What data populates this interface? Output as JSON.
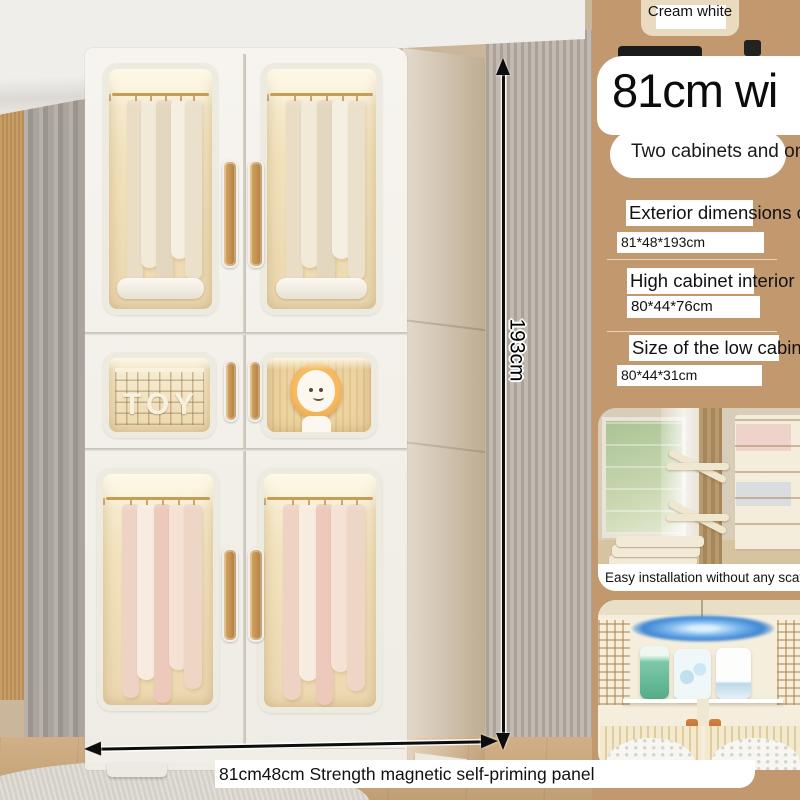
{
  "product": {
    "color_badge": "Cream white",
    "headline": "81cm wi",
    "subtitle": "Two cabinets and on",
    "specs": [
      {
        "heading": "Exterior dimensions of cab",
        "value": "81*48*193cm"
      },
      {
        "heading": "High cabinet interior siz",
        "value": "80*44*76cm"
      },
      {
        "heading": "Size of the low cabinet:",
        "value": "80*44*31cm"
      }
    ],
    "height_label": "193cm",
    "bottom_caption": "81cm48cm Strength magnetic self-priming panel",
    "feature_caption": "Easy installation without any scattere",
    "toy_basket_label": "TOY"
  },
  "colors": {
    "sidebar_tan": "#c2986f",
    "wardrobe_white": "#f3f0ea",
    "handle_wood": "#c08e4e",
    "annotation_black": "#0d0d0d",
    "highlight_white": "#ffffff"
  }
}
